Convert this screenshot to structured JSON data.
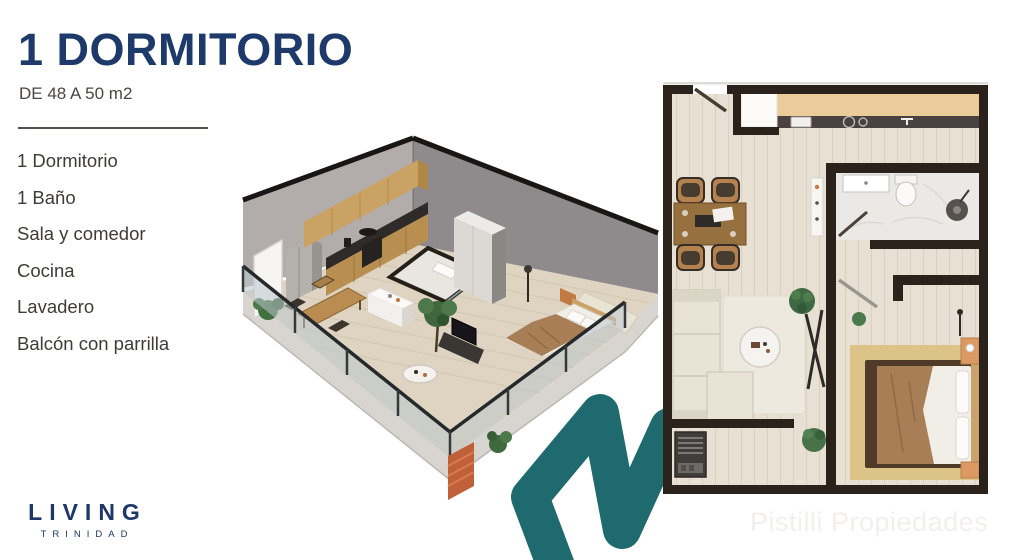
{
  "header": {
    "title": "1 DORMITORIO",
    "subtitle": "DE 48 A 50 m2"
  },
  "features": [
    "1 Dormitorio",
    "1 Baño",
    "Sala y comedor",
    "Cocina",
    "Lavadero",
    "Balcón con parrilla"
  ],
  "logo": {
    "name": "LIVING",
    "location": "TRINIDAD"
  },
  "watermark": "Pistilli Propiedades",
  "colors": {
    "accent_navy": "#1d3a6b",
    "accent_teal": "#1e6a6e"
  }
}
